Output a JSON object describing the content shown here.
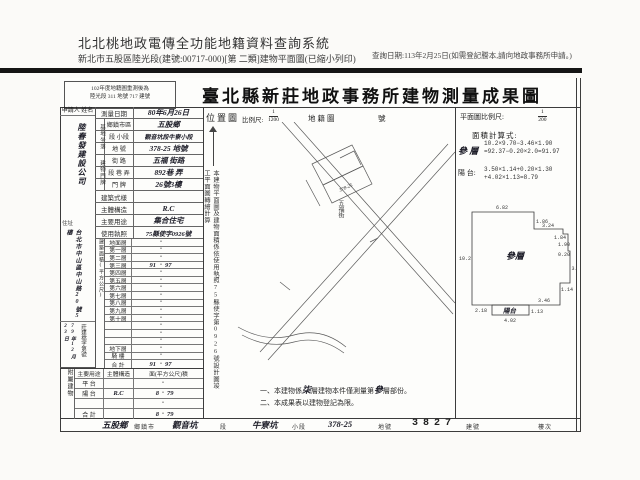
{
  "header": {
    "system_title": "北北桃地政電傳全功能地籍資料查詢系統",
    "query_line": "新北市五股區陸光段(建號:00717-000)[第 二類]建物平面圖(已縮小列印)",
    "query_date": "查詢日期:113年2月25日(如需登記謄本,請向地政事務所申請。)"
  },
  "doc": {
    "remark_line1": "102年度地籍圖重測後為",
    "remark_line2": "陸光段 311 地號 717 建號",
    "title": "臺北縣新莊地政事務所建物測量成果圖",
    "applicant": {
      "header_label": "申請人",
      "name_label": "姓名",
      "name_value": "陸春發建設公司",
      "addr_label": "住址",
      "addr_value": "台北市中山區中山路20號5樓",
      "receipt_no_label": "莊建檔字第號",
      "receipt_date_value": "79年12月23日"
    },
    "info": {
      "survey": {
        "label": "測量日期",
        "value": "80年6月26日"
      },
      "site_group": "基地坐落",
      "township": {
        "label": "鄉鎮市區",
        "value": "五股鄉"
      },
      "section": {
        "label": "段 小段",
        "value": "觀音坑段牛寮小段"
      },
      "lot": {
        "label": "地 號",
        "value": "378-25 地號"
      },
      "addr_group": "建物門牌",
      "street": {
        "label": "街 路",
        "value": "五福 街路"
      },
      "lane": {
        "label": "段 巷 弄",
        "value": "892巷 弄"
      },
      "door": {
        "label": "門 牌",
        "value": "26號3樓"
      },
      "style": {
        "label": "建築式樣",
        "value": ""
      },
      "structure": {
        "label": "主體構造",
        "value": "R.C"
      },
      "usage": {
        "label": "主要用途",
        "value": "集合住宅"
      },
      "license": {
        "label": "使用執照",
        "value": "75縣使字0926號"
      }
    },
    "floor_area": {
      "group_label": "建築面積(平方公尺)",
      "dot": "•",
      "floors": [
        {
          "label": "地面層",
          "i": "",
          "d": ""
        },
        {
          "label": "第一層",
          "i": "",
          "d": ""
        },
        {
          "label": "第二層",
          "i": "",
          "d": ""
        },
        {
          "label": "第三層",
          "i": "91",
          "d": "97"
        },
        {
          "label": "第四層",
          "i": "",
          "d": ""
        },
        {
          "label": "第五層",
          "i": "",
          "d": ""
        },
        {
          "label": "第六層",
          "i": "",
          "d": ""
        },
        {
          "label": "第七層",
          "i": "",
          "d": ""
        },
        {
          "label": "第八層",
          "i": "",
          "d": ""
        },
        {
          "label": "第九層",
          "i": "",
          "d": ""
        },
        {
          "label": "第十層",
          "i": "",
          "d": ""
        },
        {
          "label": "",
          "i": "",
          "d": ""
        },
        {
          "label": "",
          "i": "",
          "d": ""
        },
        {
          "label": "",
          "i": "",
          "d": ""
        },
        {
          "label": "地下層",
          "i": "",
          "d": ""
        },
        {
          "label": "騎 樓",
          "i": "",
          "d": ""
        },
        {
          "label": "合 計",
          "i": "91",
          "d": "97"
        }
      ]
    },
    "annex": {
      "group_label": "附屬建物",
      "col_use": "主要用途",
      "col_structure": "主體構造",
      "col_area": "面(平方公尺)積",
      "rows": [
        {
          "use": "平 台",
          "st": "",
          "i": "",
          "d": ""
        },
        {
          "use": "陽 台",
          "st": "R.C",
          "i": "8",
          "d": "79"
        },
        {
          "use": "",
          "st": "",
          "i": "",
          "d": ""
        },
        {
          "use": "合 計",
          "st": "",
          "i": "8",
          "d": "79"
        }
      ]
    },
    "map": {
      "label": "位置圖",
      "scale_label": "比例尺:",
      "scale_num": "1",
      "scale_den": "1200",
      "sheet_label": "地籍圖",
      "sheet_suffix": "號",
      "side_note": "本建物平面圖及建物面積係依使用執照75縣使字第0926號設計圖竣工平面圖轉繪計算",
      "road_label": "五福街",
      "lot_label": "378-25"
    },
    "plan": {
      "scale_label": "平面圖比例尺:",
      "scale_num": "1",
      "scale_den": "200",
      "calc_title": "面積計算式:",
      "floor_name": "參 層",
      "floor_line1": "10.2×9.70−3.46×1.90",
      "floor_line2": "=92.37−0.20×2.0=91.97",
      "balcony_name": "陽 台:",
      "balcony_line1": "3.50×1.14+0.20×1.30",
      "balcony_line2": "+4.02×1.13=8.79",
      "room_label": "參層",
      "balcony_label": "陽台",
      "dims": {
        "top": "6.82",
        "notch": "1.86",
        "top2": "3.24",
        "jog": "1.84",
        "right1": "1.90",
        "right_small": "0.20",
        "right2": "3.50",
        "right3": "1.14",
        "bottom": "3.46",
        "balcony_h": "1.13",
        "balcony_w": "4.02",
        "bottom_left": "2.18",
        "left": "10.2"
      }
    },
    "notes": {
      "n1_pre": "一、本建物係",
      "n1_hand1": "柒",
      "n1_mid": "層建物本件僅測量第",
      "n1_hand2": "參",
      "n1_post": "層部份。",
      "n2": "二、本成果表以建物登記為限。"
    },
    "bottom": {
      "township_value": "五股鄉",
      "township_label": "鄉鎮市",
      "section_value": "觀音坑",
      "section_label": "段",
      "subsection_value": "牛寮坑",
      "subsection_label": "小段",
      "lot_value": "378-25",
      "lot_label": "地號",
      "bno_value": "3827",
      "bno_label": "建號",
      "floor_label": "樓次"
    }
  }
}
